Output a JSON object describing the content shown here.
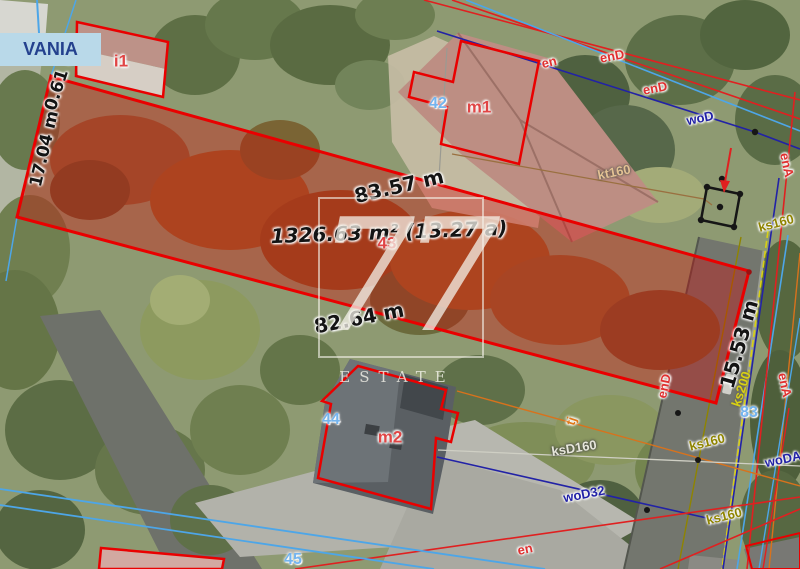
{
  "street_sign": {
    "text": "VANIA"
  },
  "watermark": {
    "logo": "77",
    "name": "ESTATE"
  },
  "plot": {
    "number": "43",
    "area": "1326.63 m² (13.27 a)",
    "edge_top": "83.57 m",
    "edge_bottom": "82.64 m",
    "edge_left": "17.04 m",
    "edge_left_jog": "0.61 m",
    "edge_right": "15.53 m"
  },
  "parcels": {
    "p42": "42",
    "p44": "44",
    "p45": "45",
    "p83": "83"
  },
  "buildings": {
    "i1": "i1",
    "m1": "m1",
    "m2": "m2"
  },
  "utilities": {
    "en_top": "en",
    "end_top": "enD",
    "end_mid": "enD",
    "wod_top": "woD",
    "ena_top": "enA",
    "ks160_top": "ks160",
    "kt160": "kt160",
    "end_right": "enD",
    "ena_right": "enA",
    "ks200": "ks200",
    "ks160_mid": "ks160",
    "woda": "woDA",
    "ks160_bot": "ks160",
    "ksd160": "ksD160",
    "wod32": "woD32",
    "tj": "tj",
    "en_bot": "en"
  },
  "colors": {
    "plot_outline": "#e90000",
    "plot_fill": "rgba(218,0,0,0.34)",
    "parcel_number_blue": "#74b4ee",
    "building_label_red": "#e04545",
    "power_red": "#e02020",
    "water_navy": "#2222a6",
    "sewer_olive": "#8f8400",
    "sewer_yellow": "#d8d014",
    "telecom_tan": "#e3c193",
    "telecom_orange": "#d8721c",
    "utility_lightblue": "#4da6e8"
  }
}
